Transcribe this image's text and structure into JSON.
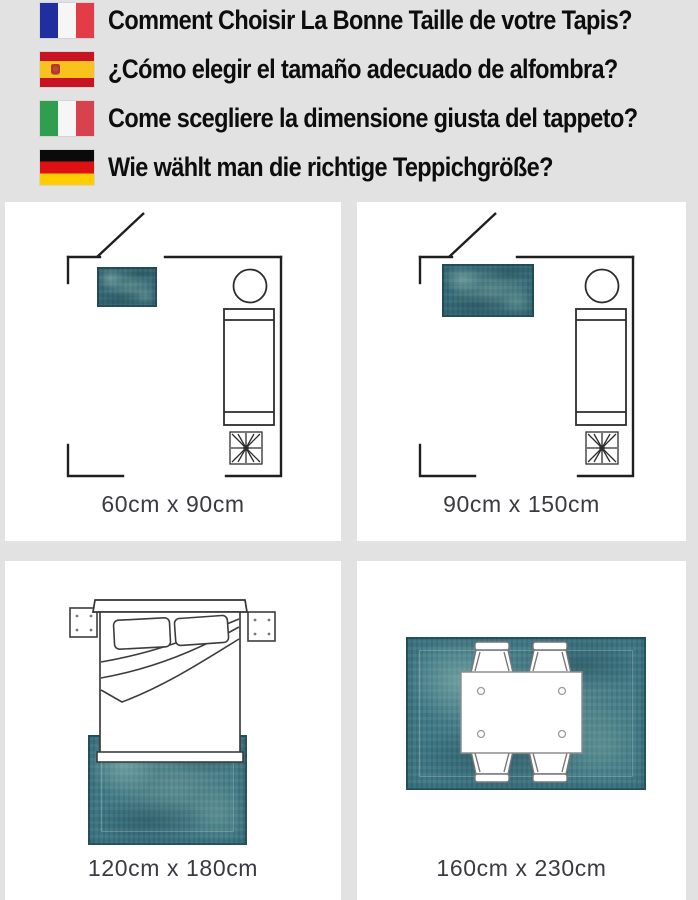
{
  "banner": {
    "background": "#e2e2e2",
    "rows": [
      {
        "flag": "france-flag",
        "text": "Comment Choisir La Bonne Taille de votre Tapis?"
      },
      {
        "flag": "spain-flag",
        "text": "¿Cómo elegir el tamaño adecuado de alfombra?"
      },
      {
        "flag": "italy-flag",
        "text": "Come scegliere la dimensione giusta del tappeto?"
      },
      {
        "flag": "germany-flag",
        "text": "Wie wählt man die richtige Teppichgröße?"
      }
    ]
  },
  "panels": [
    {
      "scene": "living-room-floorplan",
      "caption": "60cm x 90cm"
    },
    {
      "scene": "living-room-floorplan",
      "caption": "90cm x 150cm"
    },
    {
      "scene": "bedroom-top-view",
      "caption": "120cm x 180cm"
    },
    {
      "scene": "dining-table-top-view",
      "caption": "160cm x 230cm"
    }
  ],
  "colors": {
    "rug_teal": "#417a87",
    "rug_teal_dark": "#3a6f7c",
    "panel_background": "#ffffff",
    "page_background": "#e2e2e2",
    "headline_text": "#0d0d0d",
    "caption_text": "#3a3a40",
    "line_art": "#222222"
  }
}
